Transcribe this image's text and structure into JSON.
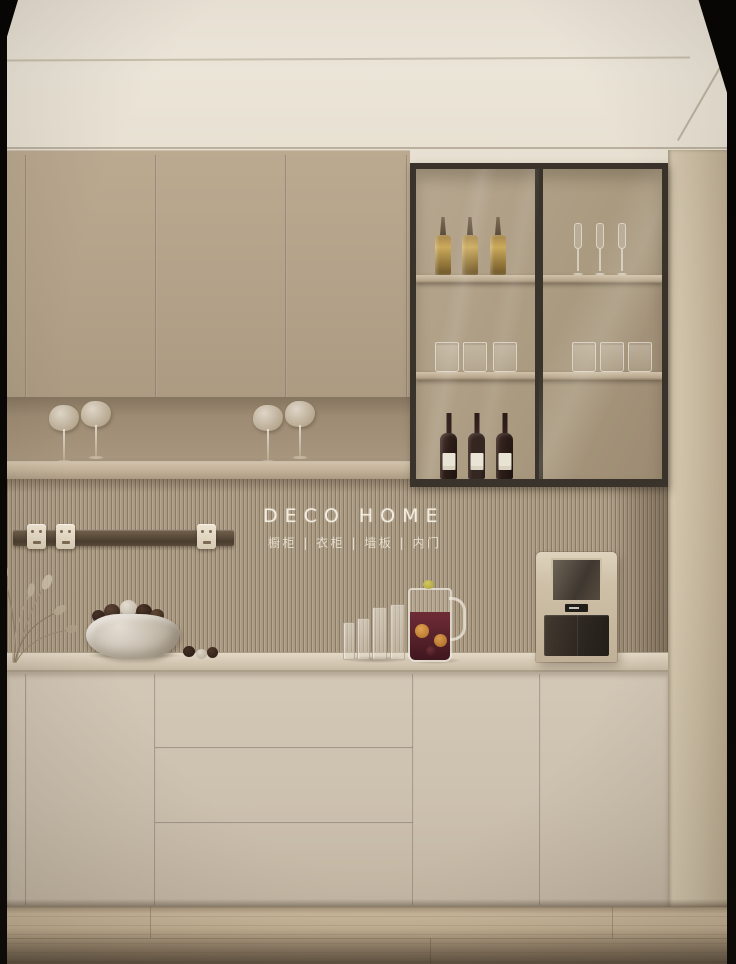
{
  "brand": {
    "logo_text": "DECO HOME",
    "tagline": "橱柜 | 衣柜 | 墙板 | 内门"
  },
  "scene": {
    "type": "interior-photo",
    "subject": "beige minimalist kitchen sideboard wall with glass display cabinet",
    "upper_cabinets": {
      "doors": 3
    },
    "glass_cabinet": {
      "doors": 2,
      "shelves": 2,
      "contents": {
        "top_left": "3 gold liquor bottles",
        "top_right": "3 champagne flutes",
        "middle_left": "3 drinking glasses",
        "middle_right": "3 drinking glasses",
        "bottom_left": "3 dark wine bottles with white labels",
        "bottom_right": "empty"
      }
    },
    "open_shelf_decor": "4 stemmed glasses with cotton puffs",
    "backsplash": "fluted wood panel with brand logo",
    "power_track_sockets": 3,
    "countertop_items": [
      "dried plant sprigs",
      "stone bowl with dark fruit",
      "4 tall glasses",
      "pitcher of sangria with orange slices",
      "water dispenser"
    ],
    "lower_cabinets": {
      "doors": 4,
      "drawers": 3
    },
    "floor": "light oak wood planks"
  },
  "colors": {
    "ceiling": "#e9e3d6",
    "upper_cabinet": "#b3a289",
    "niche_back": "#a08e76",
    "shelf_front": "#c3b29a",
    "fluted_panel": "#ab9a82",
    "counter": "#d7cbb7",
    "lower_cabinet": "#ccc0ae",
    "right_panel": "#c9bba1",
    "glass_cabinet_frame": "#39332b",
    "cabinet_interior": "#aa9a80",
    "floor_wood": "#c4b195",
    "photo_edge_black": "#060504",
    "wine_bottle": "#2a1b16",
    "gold_bottle": "#cbaa5c",
    "rail": "#4a3d2f",
    "socket": "#e3d9c6",
    "appliance_shell": "#cec0a7",
    "appliance_front": "#2c2620",
    "sangria": "#532028",
    "logo_text_color": "#f6f0e2"
  }
}
